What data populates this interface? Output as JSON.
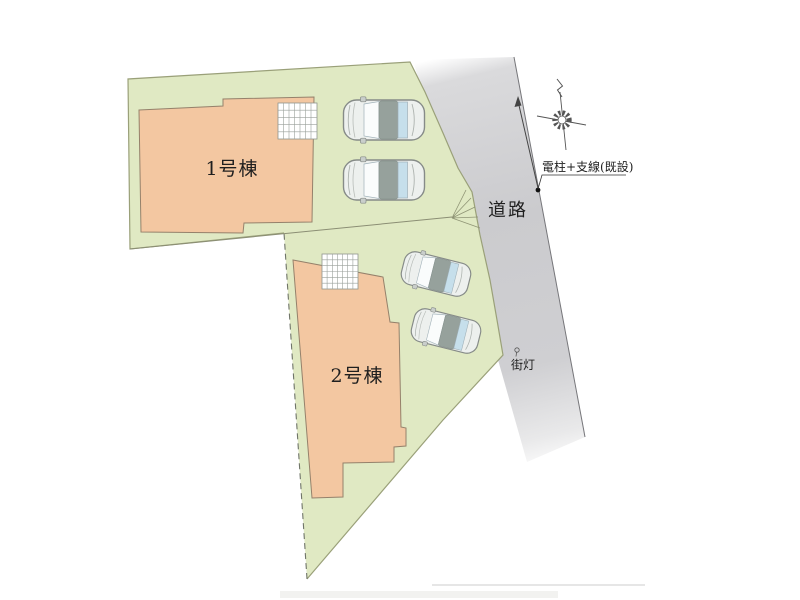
{
  "image": {
    "type": "residential-site-plan",
    "labels": {
      "building1": "1号棟",
      "building2": "2号棟",
      "road": "道路",
      "utility_pole": "電柱+支線(既設)",
      "street_light": "街灯"
    },
    "colors": {
      "lot_green": "#e0e9c3",
      "lot_border": "#9aa079",
      "building_fill": "#f3c7a1",
      "building_border": "#95816b",
      "road_gray": "#cbcbce",
      "car_body": "#edf0ee",
      "car_roof": "#96a19c",
      "car_window": "#c6dfeb",
      "annotation_text": "#1f1f1f"
    }
  }
}
